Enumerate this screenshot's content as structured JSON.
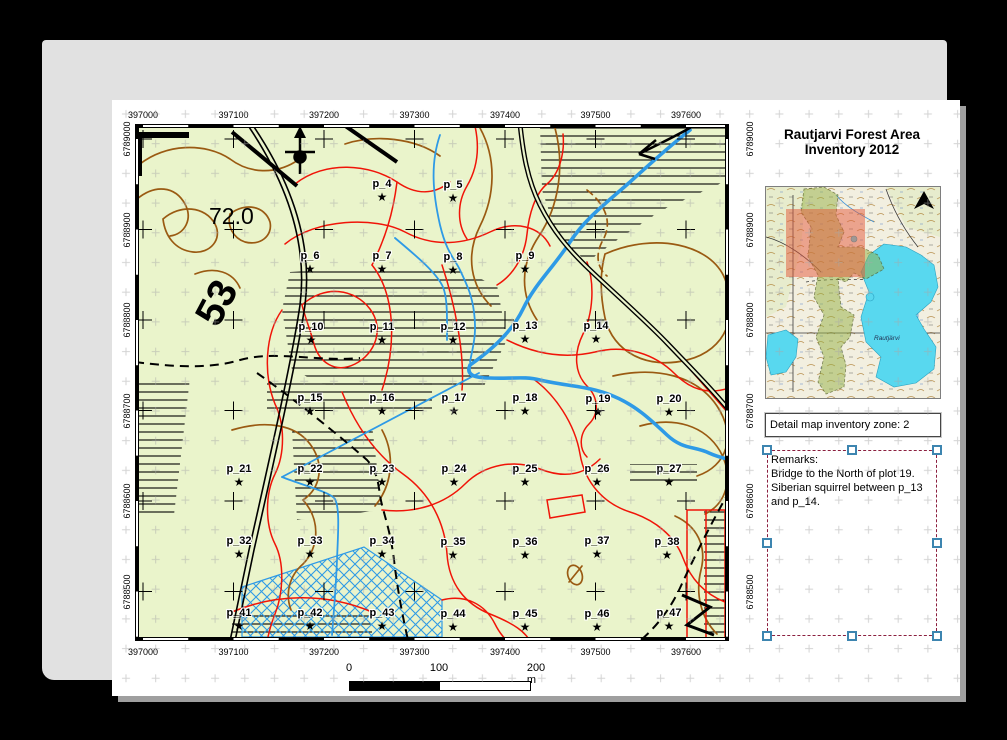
{
  "title": {
    "line1": "Rautjarvi Forest Area",
    "line2": "Inventory 2012"
  },
  "map": {
    "x_labels": [
      "397000",
      "397100",
      "397200",
      "397300",
      "397400",
      "397500",
      "397600"
    ],
    "x_px": [
      8,
      98.5,
      189,
      279.5,
      370,
      460.5,
      551
    ],
    "y_labels": [
      "6789000",
      "6788900",
      "6788800",
      "6788700",
      "6788600",
      "6788500"
    ],
    "y_px": [
      15,
      105.5,
      196,
      286.5,
      377,
      467.5
    ],
    "contour_label": "72.0",
    "road_label": "53",
    "plots": [
      {
        "id": "p_4",
        "x": 247,
        "y": 60
      },
      {
        "id": "p_5",
        "x": 318,
        "y": 61
      },
      {
        "id": "p_6",
        "x": 175,
        "y": 132
      },
      {
        "id": "p_7",
        "x": 247,
        "y": 132
      },
      {
        "id": "p_8",
        "x": 318,
        "y": 133
      },
      {
        "id": "p_9",
        "x": 390,
        "y": 132
      },
      {
        "id": "p_10",
        "x": 176,
        "y": 203
      },
      {
        "id": "p_11",
        "x": 247,
        "y": 203
      },
      {
        "id": "p_12",
        "x": 318,
        "y": 203
      },
      {
        "id": "p_13",
        "x": 390,
        "y": 202
      },
      {
        "id": "p_14",
        "x": 461,
        "y": 202
      },
      {
        "id": "p_15",
        "x": 175,
        "y": 274
      },
      {
        "id": "p_16",
        "x": 247,
        "y": 274
      },
      {
        "id": "p_17",
        "x": 319,
        "y": 274
      },
      {
        "id": "p_18",
        "x": 390,
        "y": 274
      },
      {
        "id": "p_19",
        "x": 463,
        "y": 275
      },
      {
        "id": "p_20",
        "x": 534,
        "y": 275
      },
      {
        "id": "p_21",
        "x": 104,
        "y": 345
      },
      {
        "id": "p_22",
        "x": 175,
        "y": 345
      },
      {
        "id": "p_23",
        "x": 247,
        "y": 345
      },
      {
        "id": "p_24",
        "x": 319,
        "y": 345
      },
      {
        "id": "p_25",
        "x": 390,
        "y": 345
      },
      {
        "id": "p_26",
        "x": 462,
        "y": 345
      },
      {
        "id": "p_27",
        "x": 534,
        "y": 345
      },
      {
        "id": "p_32",
        "x": 104,
        "y": 417
      },
      {
        "id": "p_33",
        "x": 175,
        "y": 417
      },
      {
        "id": "p_34",
        "x": 247,
        "y": 417
      },
      {
        "id": "p_35",
        "x": 318,
        "y": 418
      },
      {
        "id": "p_36",
        "x": 390,
        "y": 418
      },
      {
        "id": "p_37",
        "x": 462,
        "y": 417
      },
      {
        "id": "p_38",
        "x": 532,
        "y": 418
      },
      {
        "id": "p_41",
        "x": 104,
        "y": 489
      },
      {
        "id": "p_42",
        "x": 175,
        "y": 489
      },
      {
        "id": "p_43",
        "x": 247,
        "y": 489
      },
      {
        "id": "p_44",
        "x": 318,
        "y": 490
      },
      {
        "id": "p_45",
        "x": 390,
        "y": 490
      },
      {
        "id": "p_46",
        "x": 462,
        "y": 490
      },
      {
        "id": "p_47",
        "x": 534,
        "y": 489
      }
    ]
  },
  "overview": {
    "lake_label": "Rautjärvi"
  },
  "detail_label": {
    "text": "Detail map inventory zone: 2"
  },
  "remarks": {
    "title": "Remarks:",
    "lines": [
      "Bridge to the North of plot 19.",
      "Siberian squirrel between p_13",
      "and p_14."
    ]
  },
  "scalebar": {
    "ticks": [
      "0",
      "100",
      "200 m"
    ]
  },
  "colors": {
    "map_bg": "#eaf4cb",
    "water": "#2e9ae6",
    "contour": "#9a5a12",
    "stand_boundary": "#f01408",
    "selection_handle": "#3d85b0",
    "overview_lake": "#58d8ef",
    "overview_zone": "rgba(228,88,58,0.5)",
    "overview_forest": "rgba(148,175,66,0.5)"
  }
}
